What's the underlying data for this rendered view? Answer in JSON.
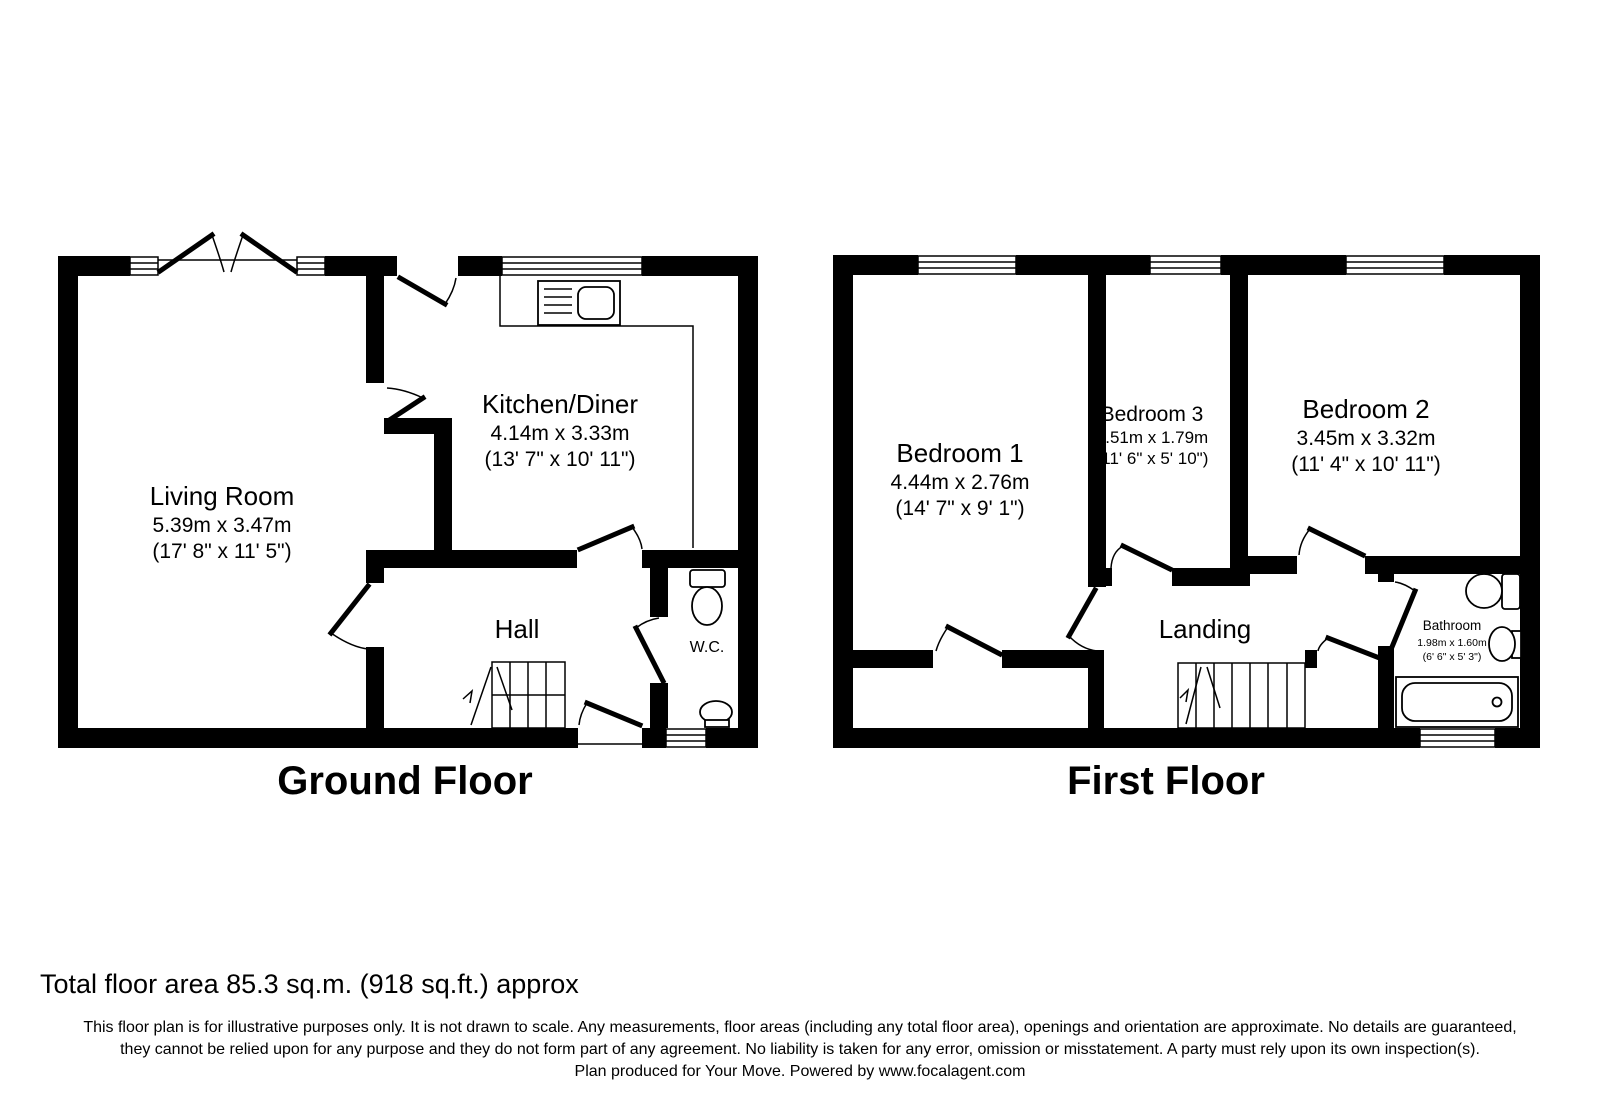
{
  "ground_floor": {
    "label": "Ground Floor",
    "rooms": {
      "living_room": {
        "name": "Living Room",
        "metric": "5.39m x 3.47m",
        "imperial": "(17' 8\" x 11' 5\")"
      },
      "kitchen": {
        "name": "Kitchen/Diner",
        "metric": "4.14m x 3.33m",
        "imperial": "(13' 7\" x 10' 11\")"
      },
      "hall": {
        "name": "Hall"
      },
      "wc": {
        "name": "W.C."
      }
    }
  },
  "first_floor": {
    "label": "First Floor",
    "rooms": {
      "bedroom1": {
        "name": "Bedroom 1",
        "metric": "4.44m x 2.76m",
        "imperial": "(14' 7\" x 9' 1\")"
      },
      "bedroom3": {
        "name": "Bedroom 3",
        "metric": "3.51m x 1.79m",
        "imperial": "(11' 6\" x 5' 10\")"
      },
      "bedroom2": {
        "name": "Bedroom 2",
        "metric": "3.45m x 3.32m",
        "imperial": "(11' 4\" x 10' 11\")"
      },
      "landing": {
        "name": "Landing"
      },
      "bathroom": {
        "name": "Bathroom",
        "metric": "1.98m x 1.60m",
        "imperial": "(6' 6\" x 5' 3\")"
      }
    }
  },
  "footer": {
    "total_area": "Total floor area 85.3 sq.m. (918 sq.ft.) approx",
    "disclaimer_line1": "This floor plan is for illustrative purposes only. It is not drawn to scale. Any measurements, floor areas (including any total floor area), openings and orientation are approximate. No details are guaranteed,",
    "disclaimer_line2": "they cannot be relied upon for any purpose and they do not form part of any agreement. No liability is taken for any error, omission or misstatement. A party must rely upon its own inspection(s).",
    "disclaimer_line3": "Plan produced for Your Move. Powered by www.focalagent.com"
  },
  "colors": {
    "wall": "#000000",
    "background": "#ffffff",
    "text": "#000000"
  }
}
